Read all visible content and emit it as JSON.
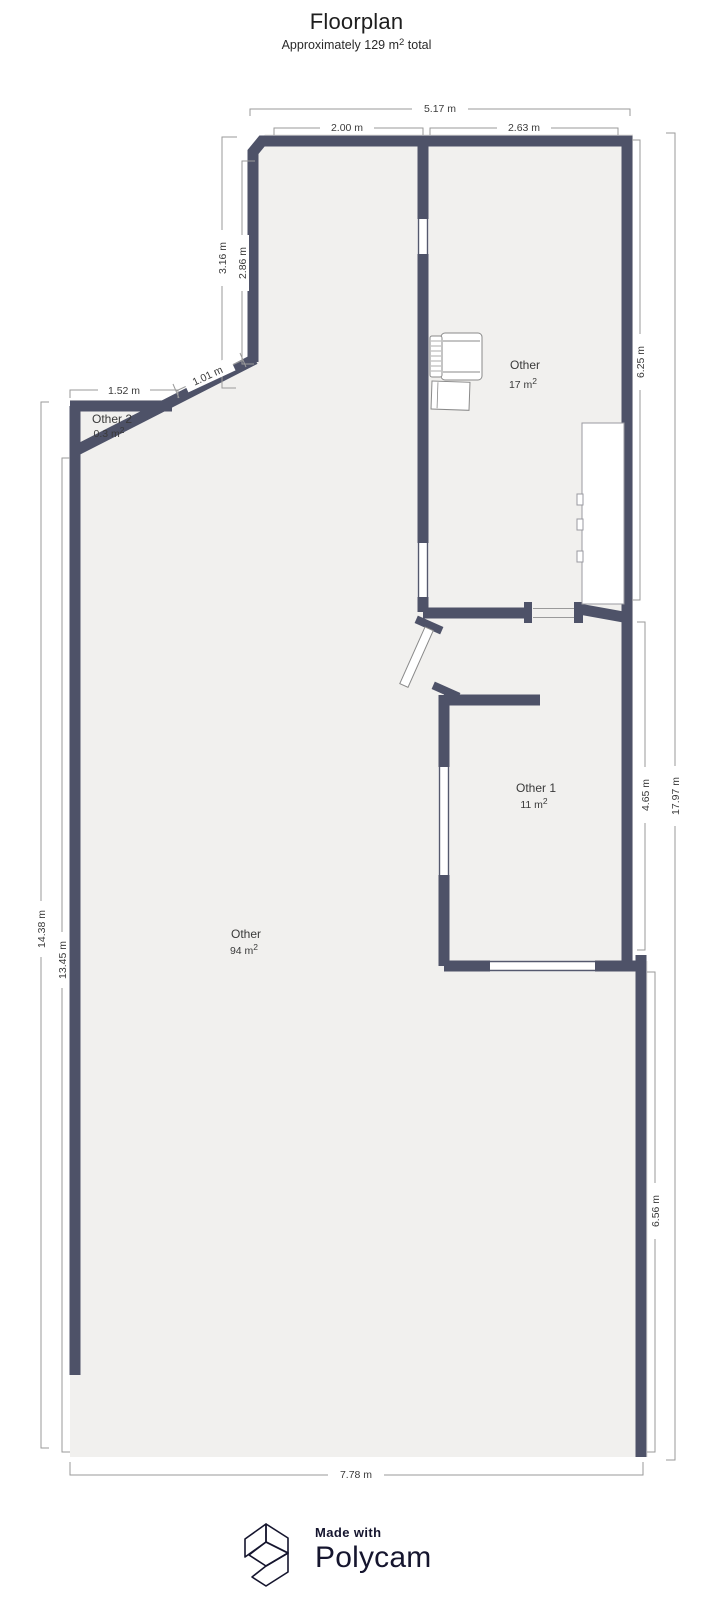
{
  "title": "Floorplan",
  "subtitle": {
    "text": "Approximately 129 m",
    "sup": "2",
    "tail": " total"
  },
  "rooms": [
    {
      "name": "Other 2",
      "area": "0.3 m",
      "sup": "2"
    },
    {
      "name": "Other",
      "area": "17 m",
      "sup": "2"
    },
    {
      "name": "Other 1",
      "area": "11 m",
      "sup": "2"
    },
    {
      "name": "Other",
      "area": "94 m",
      "sup": "2"
    }
  ],
  "dimensions": {
    "top_overall": "5.17 m",
    "top_left_segment": "2.00 m",
    "top_right_segment": "2.63 m",
    "upper_left_outer": "3.16 m",
    "upper_left_inner": "2.86 m",
    "other2_width": "1.52 m",
    "diagonal_wall": "1.01 m",
    "left_outer": "14.38 m",
    "left_inner": "13.45 m",
    "right_room_top": "6.25 m",
    "right_room_mid": "4.65 m",
    "right_room_bottom": "6.56 m",
    "right_overall": "17.97 m",
    "bottom_overall": "7.78 m"
  },
  "footer": {
    "made_with": "Made with",
    "brand": "Polycam"
  },
  "colors": {
    "wall": "#4e5268",
    "floor": "#f1f0ee",
    "dimension_line": "#9a9a9a",
    "label_text": "#3a3a3a",
    "brand_navy": "#15152e",
    "background": "#ffffff"
  }
}
